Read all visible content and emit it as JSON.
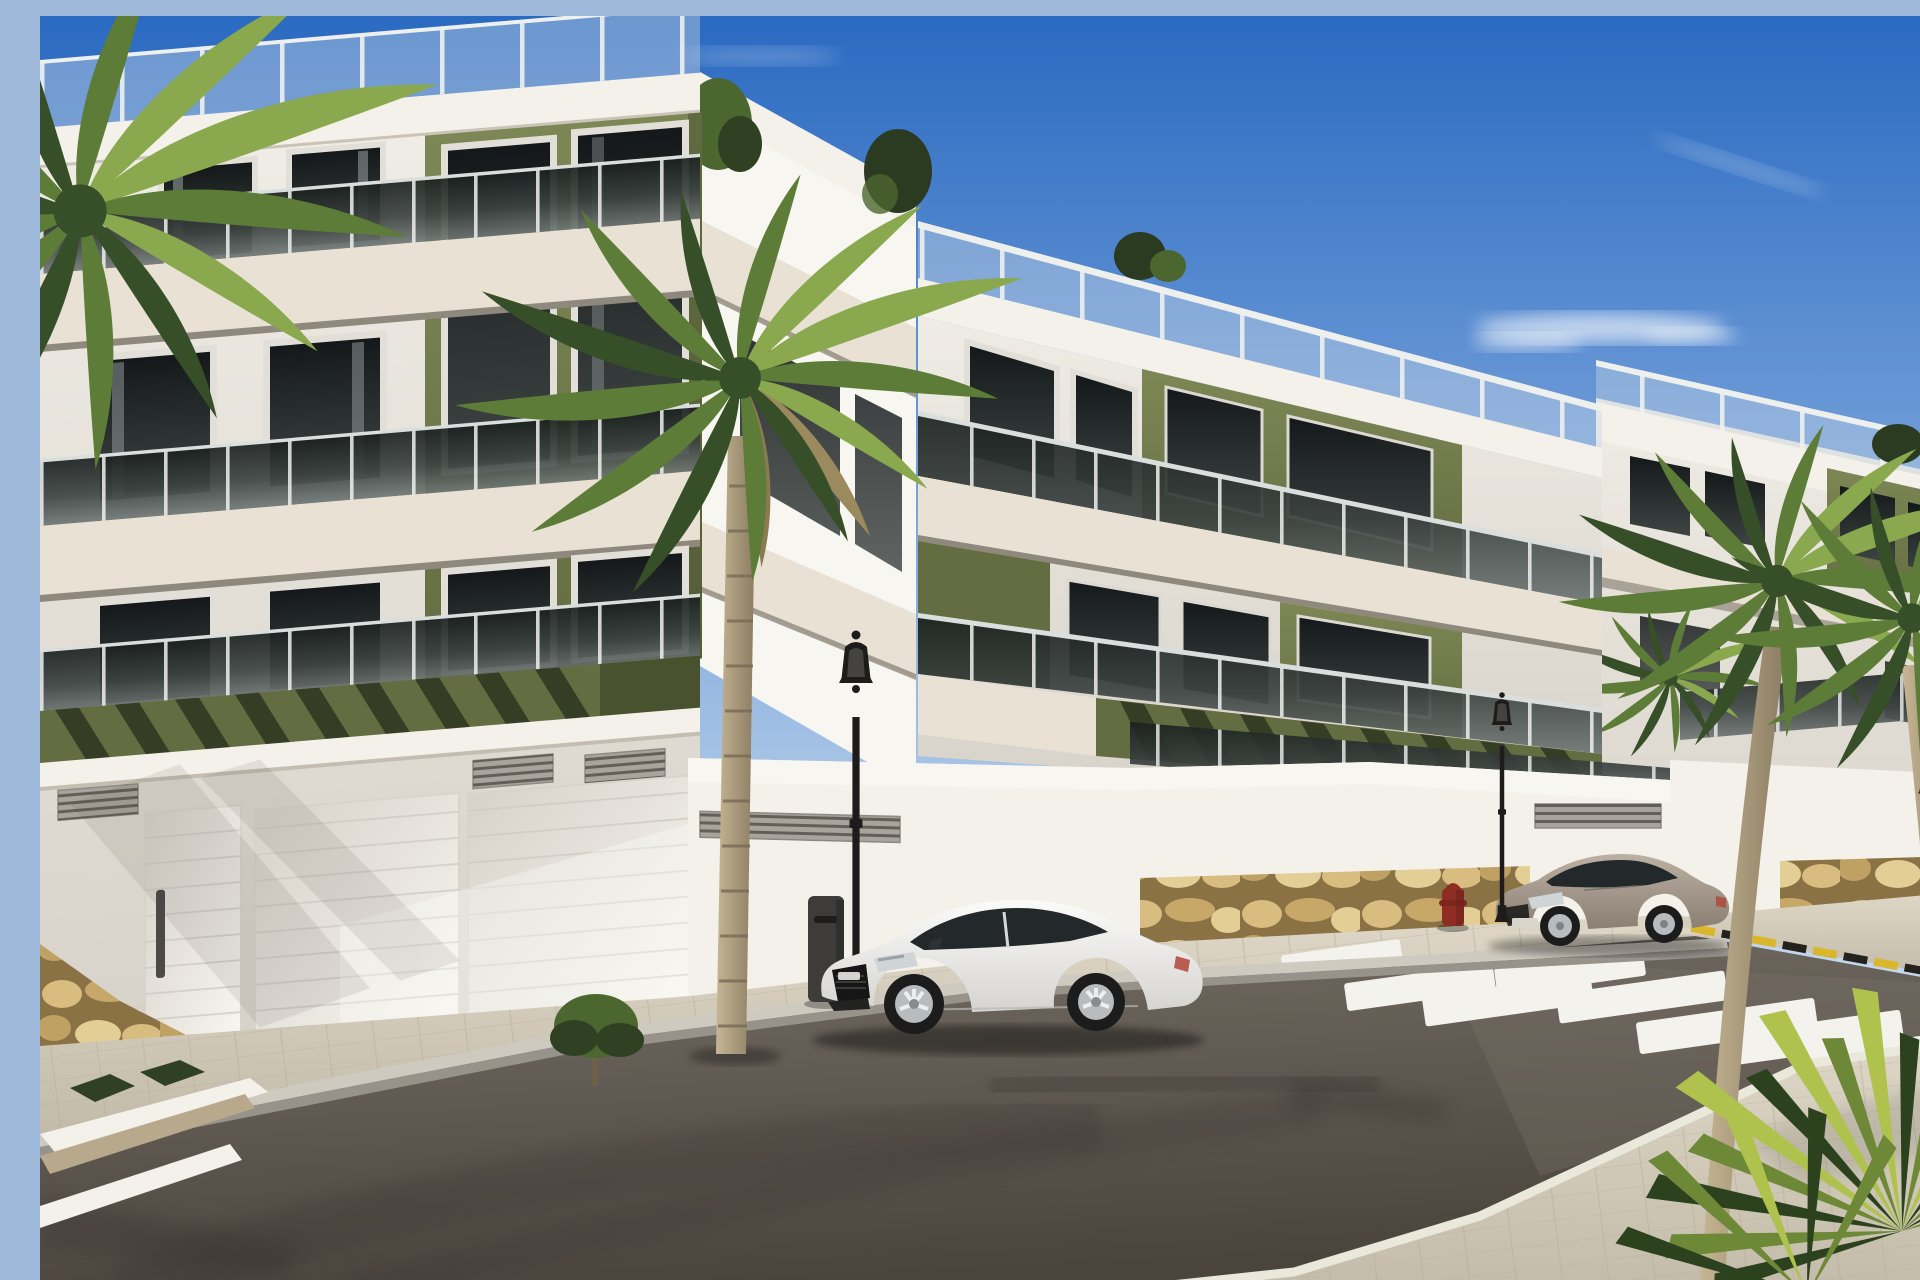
{
  "scene": {
    "type": "architectural-render",
    "description": "Sunny 3D architectural rendering of a modern three-storey apartment complex with white facades and olive-green accent panels, smoked-glass balcony balustrades, rooftop terraces with glass railings and plants, street-level garage walls on a rubble-stone base, palm trees along a fresh asphalt street with a zebra crosswalk, a white sports coupe and a beige coupe parked at the kerb, classic black street lamps, a red fire hydrant and a clear blue sky.",
    "sky": {
      "condition": "clear with thin wispy clouds",
      "cloud_count": 3
    },
    "buildings": {
      "storeys": 3,
      "style": "modern Mediterranean new-build",
      "facade_colors": [
        "white",
        "cream",
        "olive-green"
      ],
      "features": [
        "glass balcony balustrades",
        "roof terraces with glass railings",
        "olive pergola slats",
        "garage doors",
        "ventilation grilles",
        "rubble stone base",
        "rooftop plants",
        "balcony shrubs"
      ]
    },
    "street": {
      "surface": "new dark asphalt with tire marks",
      "crosswalk_stripes": 8,
      "hazard_curb_marking": "yellow-black dashes",
      "sidewalk": "light tan paving blocks with grey kerb",
      "planter_boxes": 2
    },
    "objects": [
      {
        "name": "white-sports-coupe",
        "color_key": "car_white",
        "position": "parked centre foreground, facing left"
      },
      {
        "name": "beige-coupe",
        "color_key": "car_beige",
        "position": "parked right middle distance, facing left"
      },
      {
        "name": "street-lamp",
        "count": 3,
        "style": "classic black lantern"
      },
      {
        "name": "fire-hydrant",
        "count": 1,
        "color_key": "hydrant_red"
      },
      {
        "name": "litter-bin",
        "count": 1
      },
      {
        "name": "palm-tree",
        "count": 5
      },
      {
        "name": "yucca-shrub",
        "count": 1,
        "position": "bottom right corner"
      },
      {
        "name": "garage-door",
        "count": 3
      }
    ]
  },
  "colors": {
    "sky_top": "#2a6ac1",
    "sky_mid": "#6f9cd8",
    "sky_low": "#b7cfe9",
    "sky_horizon": "#e2ebf5",
    "cloud_white": "#ffffff",
    "facade_white": "#efece5",
    "facade_bright": "#f8f6f1",
    "facade_shadow": "#d7d2c9",
    "cornice_white": "#f4f1ea",
    "fascia_cream": "#e9e2d4",
    "soffit_dark": "#8e887d",
    "olive_light": "#7d8755",
    "olive_mid": "#646d41",
    "olive_dark": "#49522f",
    "pergola_slat": "#353d24",
    "glass_dark": "#1b211f",
    "glass_mid": "#3b4240",
    "glass_light": "#6f7674",
    "rail_post": "#eef0ee",
    "roof_glass": "#c9d6e4",
    "window_frame": "#e2dfd8",
    "window_glass_dark": "#14181a",
    "window_glass_light": "#3e4543",
    "curtain_gray": "#9aa0a1",
    "stone_joint": "#8a7244",
    "stone_1": "#d9bc80",
    "stone_2": "#c8a868",
    "stone_3": "#e3ce96",
    "stone_4": "#bfa163",
    "sidewalk_light": "#ded7c7",
    "sidewalk_shade": "#c3bba9",
    "paver_line": "#b5ab97",
    "curb_top": "#cfcabf",
    "curb_face": "#97928a",
    "gutter_dark": "#5f5a53",
    "asphalt_light": "#756e65",
    "asphalt_dark": "#4a443d",
    "tire_mark": "#332f2a",
    "crosswalk_white": "#f4f2ec",
    "hazard_yellow": "#d9b62a",
    "hazard_black": "#25221e",
    "lamp_black": "#1e1c1a",
    "hydrant_red": "#8e2d24",
    "bin_gray": "#3d3c3a",
    "car_white": "#f2f1ee",
    "car_white_shade": "#d5d4d1",
    "car_glass": "#23282b",
    "car_grille": "#161616",
    "wheel_tire": "#1c1c1c",
    "wheel_rim": "#b8bcbf",
    "tail_red": "#b2453a",
    "car_beige": "#ab9f91",
    "car_beige_shade": "#8a7f73",
    "trunk_light": "#c6b694",
    "trunk_dark": "#8a7b62",
    "trunk_ring": "#776a55",
    "frond_light": "#8aa84e",
    "frond_mid": "#5d7c38",
    "frond_dark": "#374f28",
    "yucca_light": "#aec24d",
    "yucca_mid": "#6d8836",
    "yucca_dark": "#2c421e",
    "shrub_dark": "#2f4023",
    "shrub_mid": "#4c6630",
    "roof_tree": "#2b3b22",
    "door_panel": "#efede8",
    "door_line": "#cfccc5",
    "vent_body": "#a8a49b",
    "vent_slat": "#57534c"
  }
}
